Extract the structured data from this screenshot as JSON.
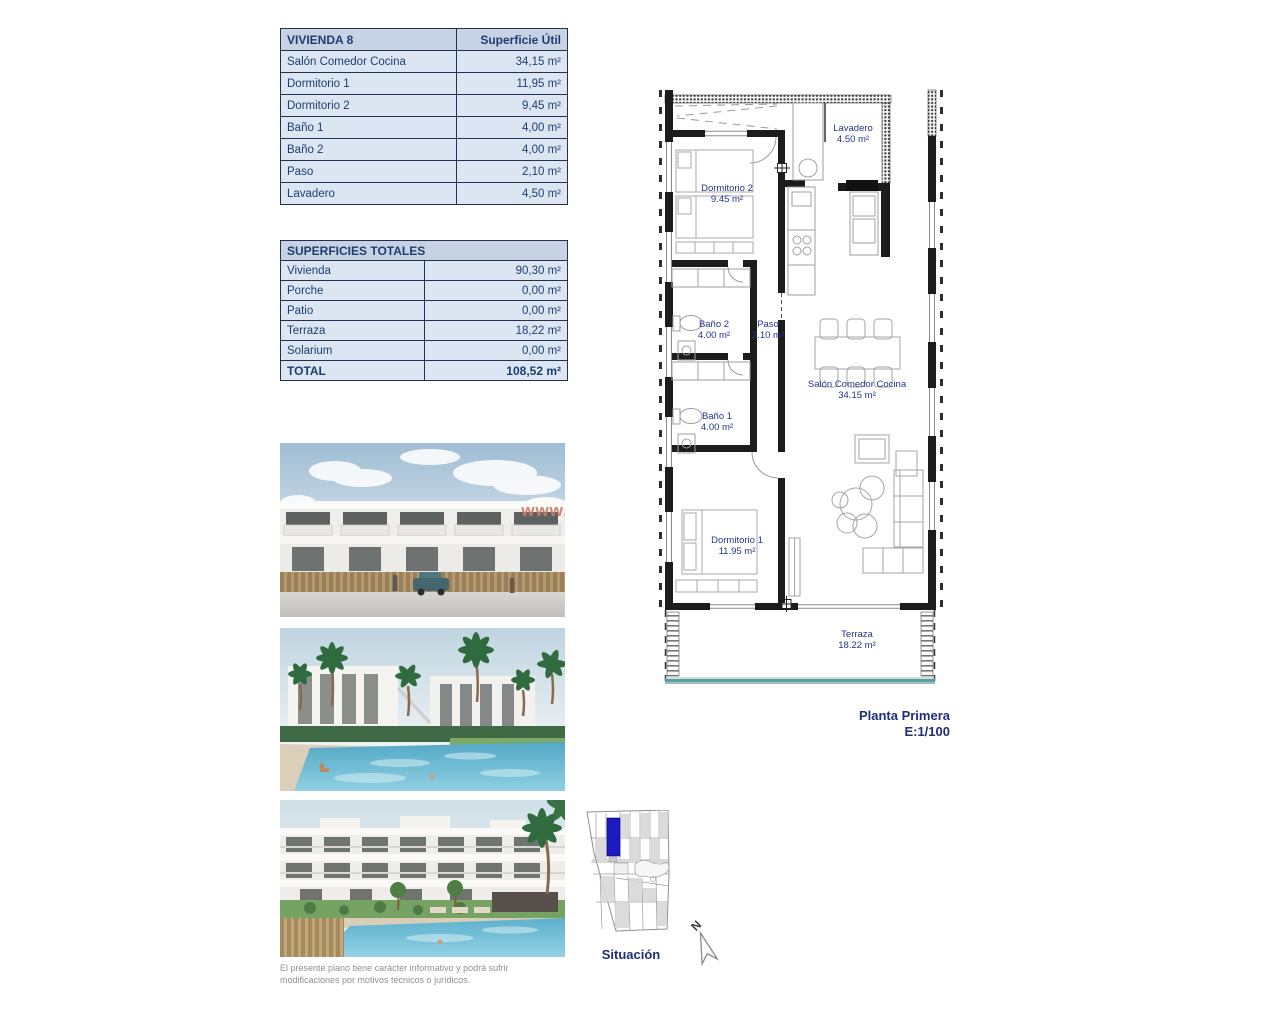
{
  "surface_table": {
    "title": "VIVIENDA 8",
    "header_right": "Superficie Útil",
    "rows": [
      {
        "label": "Salón Comedor Cocina",
        "value": "34,15 m²"
      },
      {
        "label": "Dormitorio 1",
        "value": "11,95 m²"
      },
      {
        "label": "Dormitorio 2",
        "value": "9,45 m²"
      },
      {
        "label": "Baño 1",
        "value": "4,00 m²"
      },
      {
        "label": "Baño 2",
        "value": "4,00 m²"
      },
      {
        "label": "Paso",
        "value": "2,10 m²"
      },
      {
        "label": "Lavadero",
        "value": "4,50 m²"
      }
    ]
  },
  "totals_table": {
    "title": "SUPERFICIES TOTALES",
    "rows": [
      {
        "label": "Vivienda",
        "value": "90,30 m²"
      },
      {
        "label": "Porche",
        "value": "0,00 m²"
      },
      {
        "label": "Patio",
        "value": "0,00 m²"
      },
      {
        "label": "Terraza",
        "value": "18,22 m²"
      },
      {
        "label": "Solarium",
        "value": "0,00 m²"
      }
    ],
    "total_row": {
      "label": "TOTAL",
      "value": "108,52 m²"
    }
  },
  "floorplan": {
    "rooms": {
      "dormitorio2": {
        "name": "Dormitorio 2",
        "area": "9.45 m²"
      },
      "lavadero": {
        "name": "Lavadero",
        "area": "4.50 m²"
      },
      "bano2": {
        "name": "Baño 2",
        "area": "4.00 m²"
      },
      "paso": {
        "name": "Paso",
        "area": "2.10 m²"
      },
      "bano1": {
        "name": "Baño 1",
        "area": "4.00 m²"
      },
      "salon": {
        "name": "Salón Comedor Cocina",
        "area": "34.15 m²"
      },
      "dormitorio1": {
        "name": "Dormitorio 1",
        "area": "11.95 m²"
      },
      "terraza": {
        "name": "Terraza",
        "area": "18.22 m²"
      }
    },
    "caption": {
      "title": "Planta Primera",
      "scale": "E:1/100"
    }
  },
  "site_plan": {
    "label": "Situación",
    "north_letter": "N"
  },
  "renders": {
    "watermark": "www."
  },
  "disclaimer": {
    "line1": "El presente plano tiene carácter informativo y podrá sufrir",
    "line2": "modificaciones por motivos técnicos o jurídicos."
  },
  "colors": {
    "table_header_bg": "#c7d3e4",
    "table_row_bg": "#dce6f2",
    "table_border": "#233150",
    "text_navy": "#1c3e70",
    "plan_label_navy": "#26348c",
    "terrace_glass_teal": "#55a2a6",
    "watermark_orange": "#cb7c68",
    "site_highlight_blue": "#1b1bbf"
  }
}
